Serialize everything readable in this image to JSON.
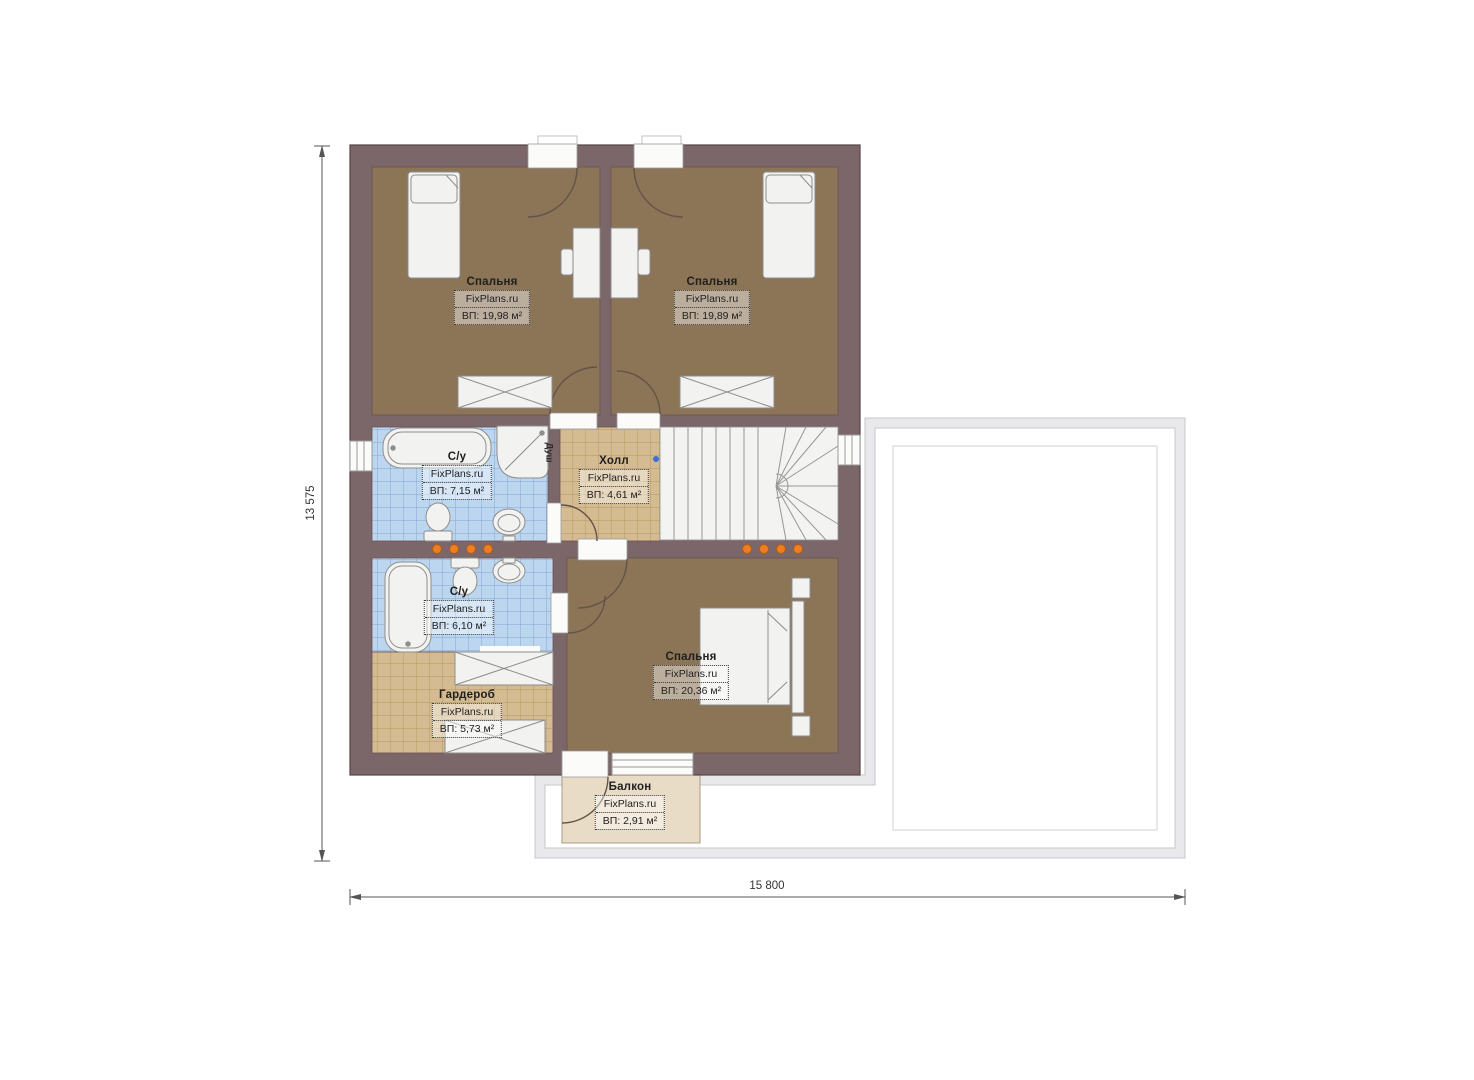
{
  "plan": {
    "rooms": [
      {
        "key": "bedroom-1",
        "name": "Спальня",
        "brand": "FixPlans.ru",
        "area": "ВП: 19,98 м²"
      },
      {
        "key": "bedroom-2",
        "name": "Спальня",
        "brand": "FixPlans.ru",
        "area": "ВП: 19,89 м²"
      },
      {
        "key": "bathroom-1",
        "name": "С/у",
        "brand": "FixPlans.ru",
        "area": "ВП: 7,15 м²"
      },
      {
        "key": "hall",
        "name": "Холл",
        "brand": "FixPlans.ru",
        "area": "ВП: 4,61 м²"
      },
      {
        "key": "bathroom-2",
        "name": "С/у",
        "brand": "FixPlans.ru",
        "area": "ВП: 6,10 м²"
      },
      {
        "key": "wardrobe",
        "name": "Гардероб",
        "brand": "FixPlans.ru",
        "area": "ВП: 5,73 м²"
      },
      {
        "key": "bedroom-3",
        "name": "Спальня",
        "brand": "FixPlans.ru",
        "area": "ВП: 20,36 м²"
      },
      {
        "key": "balcony",
        "name": "Балкон",
        "brand": "FixPlans.ru",
        "area": "ВП: 2,91 м²"
      }
    ],
    "annotations": {
      "shower": "Душ"
    },
    "dimensions": {
      "overall_height_mm": "13 575",
      "overall_width_mm": "15 800"
    }
  },
  "colors": {
    "wall": "#7b6769",
    "wall_dark": "#554647",
    "bedroom_floor": "#8c7456",
    "bath_tile": "#bcd6ef",
    "bath_tile_line": "#84a6d0",
    "hall_tile": "#d4bb91",
    "hall_tile_line": "#b4945f",
    "balcony": "#e9dcc6",
    "terrace_band": "#e9e9ec",
    "terrace_line": "#c7c7cc",
    "dot_orange": "#ee7e23",
    "dot_blue": "#3f6fd1"
  }
}
